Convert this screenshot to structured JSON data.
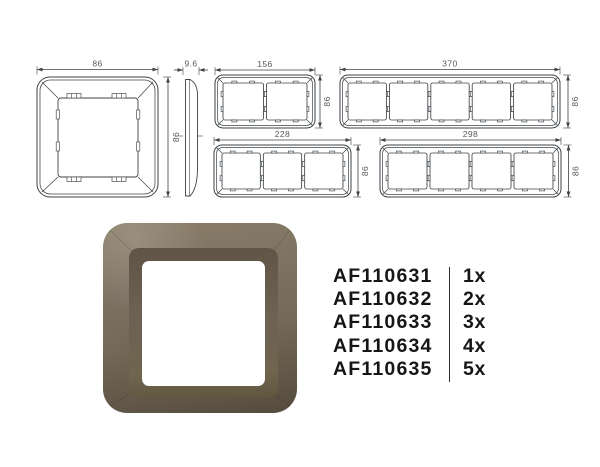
{
  "drawings": {
    "line_color": "#3e4347",
    "dim_color": "#54585c",
    "single": {
      "width_label": "86",
      "height_label": "86",
      "modules": 1
    },
    "profile": {
      "depth_label": "9.6"
    },
    "gang2": {
      "width_label": "156",
      "height_label": "86",
      "modules": 2
    },
    "gang3": {
      "width_label": "228",
      "height_label": "86",
      "modules": 3
    },
    "gang4": {
      "width_label": "298",
      "height_label": "86",
      "modules": 4
    },
    "gang5": {
      "width_label": "370",
      "height_label": "86",
      "modules": 5
    }
  },
  "render": {
    "face_top": "#8a7d68",
    "face_mid": "#746857",
    "face_bottom": "#554b3d",
    "bevel_top": "#5f5445",
    "bevel_mid": "#6d6253",
    "bevel_bottom": "#60553f",
    "window_color": "#ffffff"
  },
  "products": {
    "items": [
      {
        "code": "AF110631",
        "qty": "1x"
      },
      {
        "code": "AF110632",
        "qty": "2x"
      },
      {
        "code": "AF110633",
        "qty": "3x"
      },
      {
        "code": "AF110634",
        "qty": "4x"
      },
      {
        "code": "AF110635",
        "qty": "5x"
      }
    ]
  }
}
